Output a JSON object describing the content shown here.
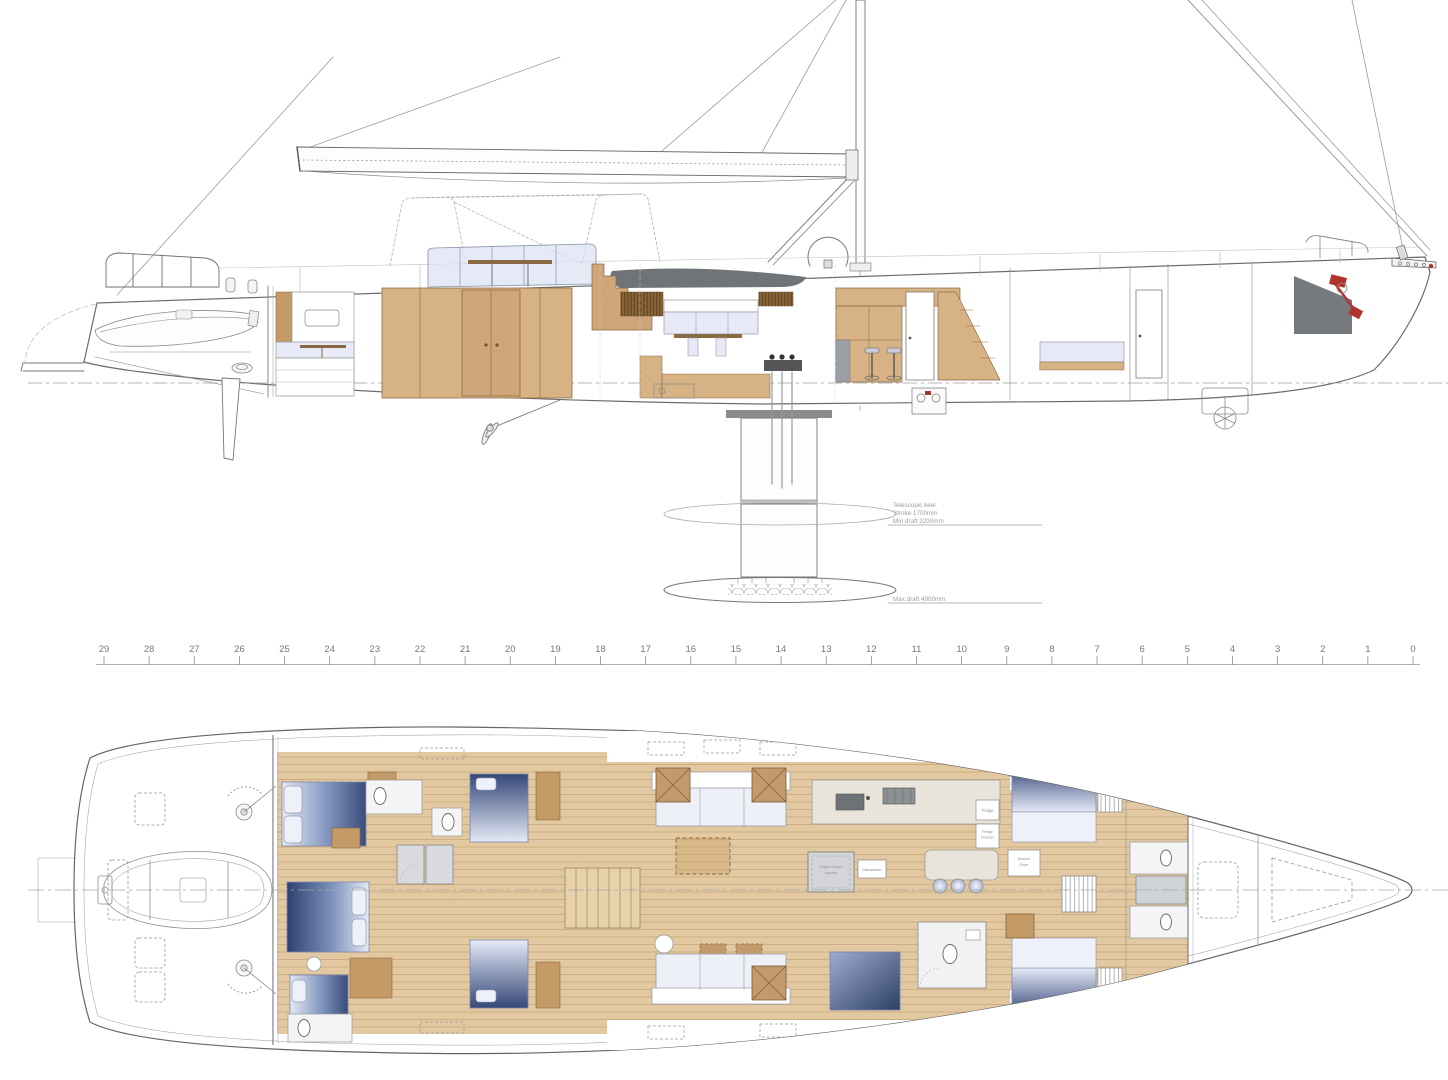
{
  "title": "Sailing yacht general arrangement drawing — sail plan profile with telescopic keel and lower-deck layout plan",
  "colors": {
    "paper": "#ffffff",
    "line": "#6f6f6f",
    "wood": "#e2c9a2",
    "wood_dark": "#c49a67",
    "glazing": "#dde3f4",
    "mattress_navy": "#33456f",
    "mattress_light": "#e9edf8",
    "wet_gray": "#d8dadf",
    "accent_red": "#b2332e",
    "annotation_gray": "#98a0a5"
  },
  "profile": {
    "keel_note": [
      "Telescopic keel",
      "Stroke 1700mm",
      "Min draft 3200mm"
    ],
    "max_draft_note": "Max draft 4900mm"
  },
  "ruler": {
    "stations": [
      "29",
      "28",
      "27",
      "26",
      "25",
      "24",
      "23",
      "22",
      "21",
      "20",
      "19",
      "18",
      "17",
      "16",
      "15",
      "14",
      "13",
      "12",
      "11",
      "10",
      "9",
      "8",
      "7",
      "6",
      "5",
      "4",
      "3",
      "2",
      "1",
      "0"
    ]
  },
  "plan": {
    "labels": {
      "fridge": "Fridge",
      "fridge_freezer_1": "Fridge",
      "fridge_freezer_2": "Freezer",
      "washer_1": "Washer",
      "washer_2": "Dryer",
      "dishwasher": "Dishwasher",
      "engine_room_1": "Engine Room",
      "engine_room_2": "Access"
    }
  }
}
